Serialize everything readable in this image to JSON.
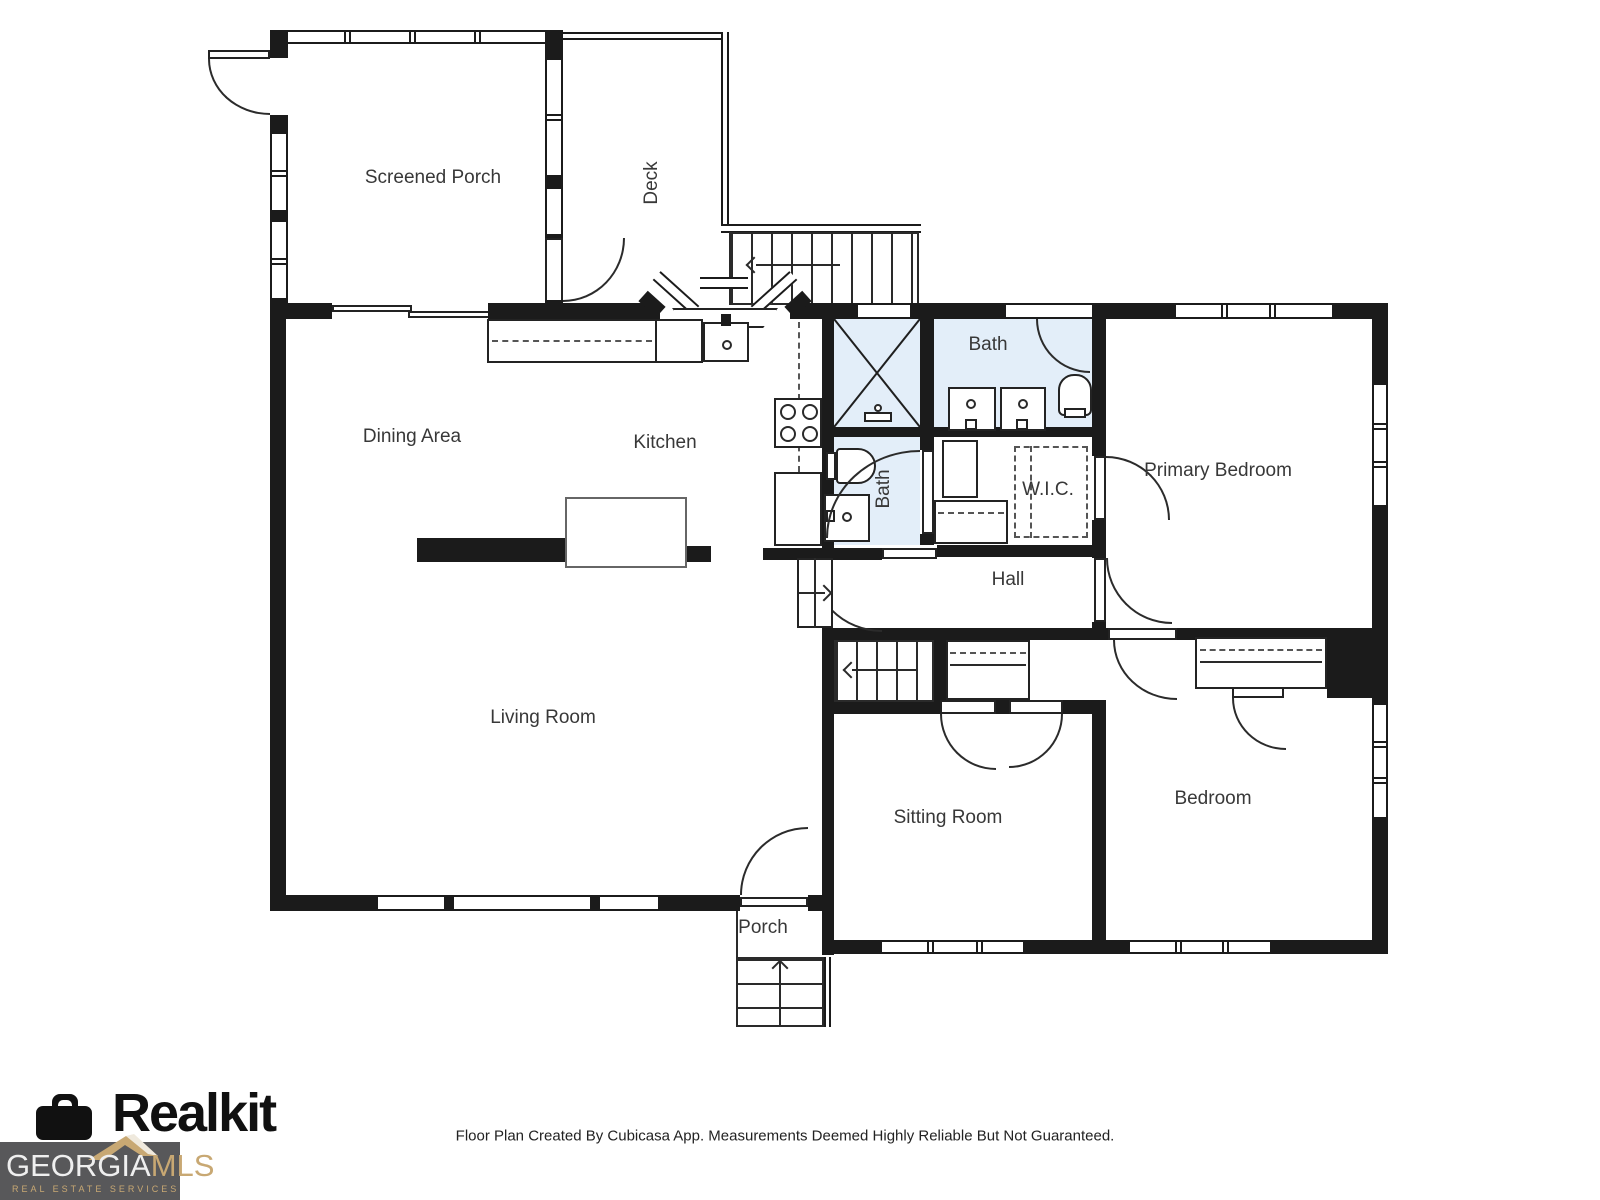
{
  "plan": {
    "rooms": {
      "screened_porch": "Screened Porch",
      "deck": "Deck",
      "dining_area": "Dining Area",
      "kitchen": "Kitchen",
      "bath_top": "Bath",
      "bath_lower": "Bath",
      "wic": "W.I.C.",
      "primary_bedroom": "Primary Bedroom",
      "hall": "Hall",
      "living_room": "Living Room",
      "sitting_room": "Sitting Room",
      "bedroom": "Bedroom",
      "porch": "Porch"
    }
  },
  "footer": {
    "disclaimer": "Floor Plan Created By Cubicasa App. Measurements Deemed Highly Reliable But Not Guaranteed."
  },
  "branding": {
    "app_name": "Realkit",
    "mls_name_primary": "GEORGIA",
    "mls_name_accent": "MLS",
    "mls_tagline": "REAL ESTATE SERVICES"
  },
  "colors": {
    "wall": "#1b1b1b",
    "bath_fill": "#e3eef9",
    "mls_badge_bg": "#58585a",
    "mls_gold": "#c8a873",
    "label_text": "#383838"
  }
}
